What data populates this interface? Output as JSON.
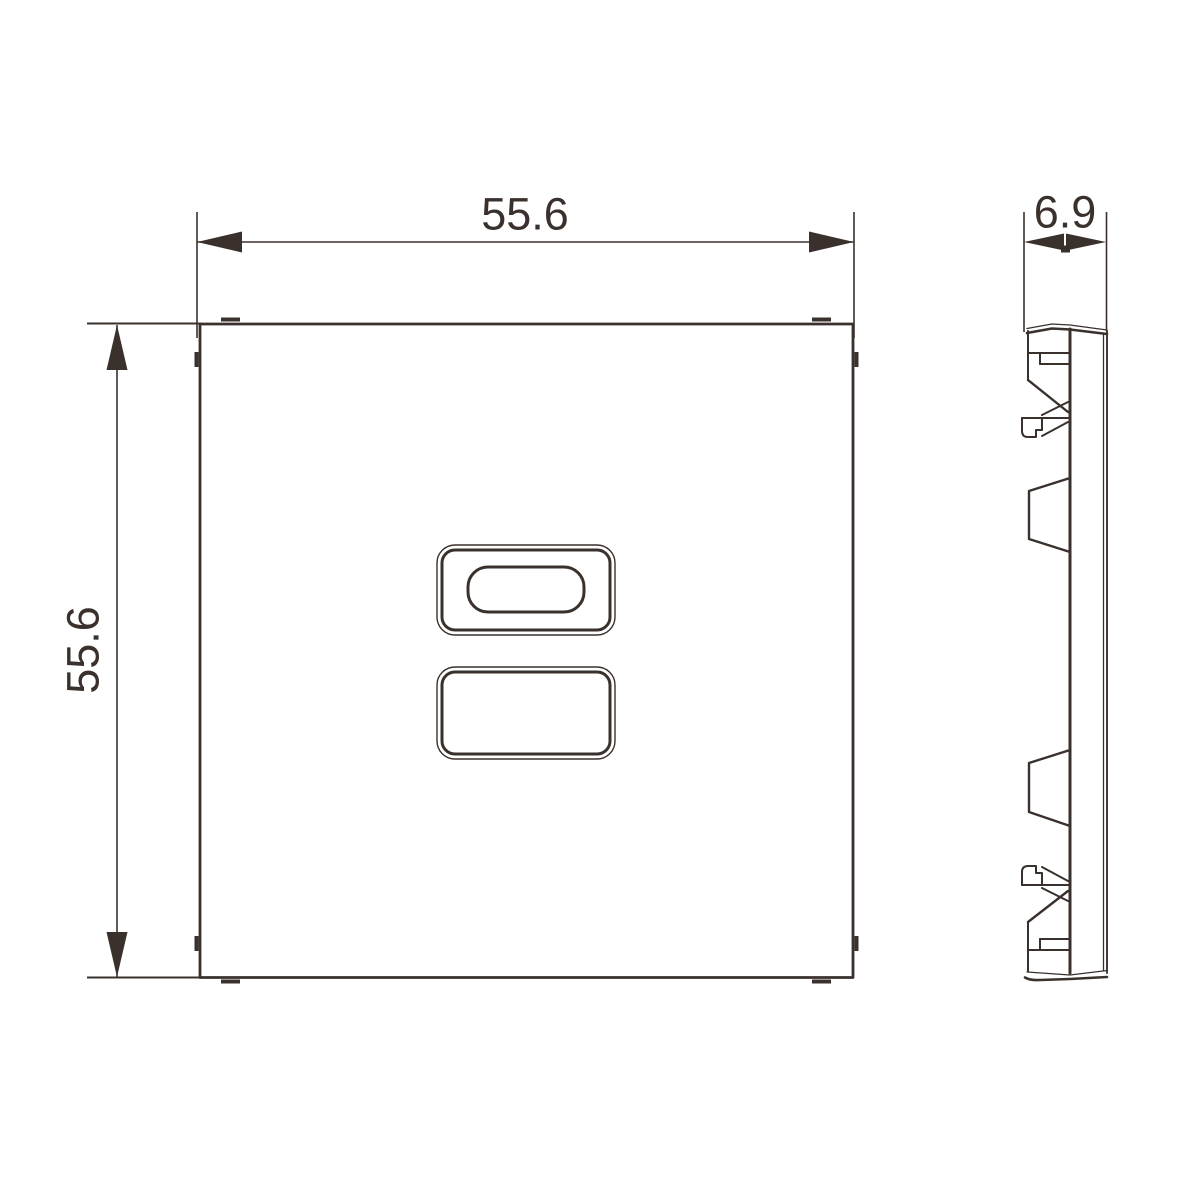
{
  "drawing": {
    "type": "technical-dimension-drawing",
    "views": {
      "front": "front view of square cover plate with two rounded openings",
      "side": "side profile with mounting clips"
    },
    "dimensions": {
      "width": "55.6",
      "height": "55.6",
      "depth": "6.9"
    },
    "colors": {
      "line": "#3a312d",
      "background": "#ffffff"
    }
  }
}
